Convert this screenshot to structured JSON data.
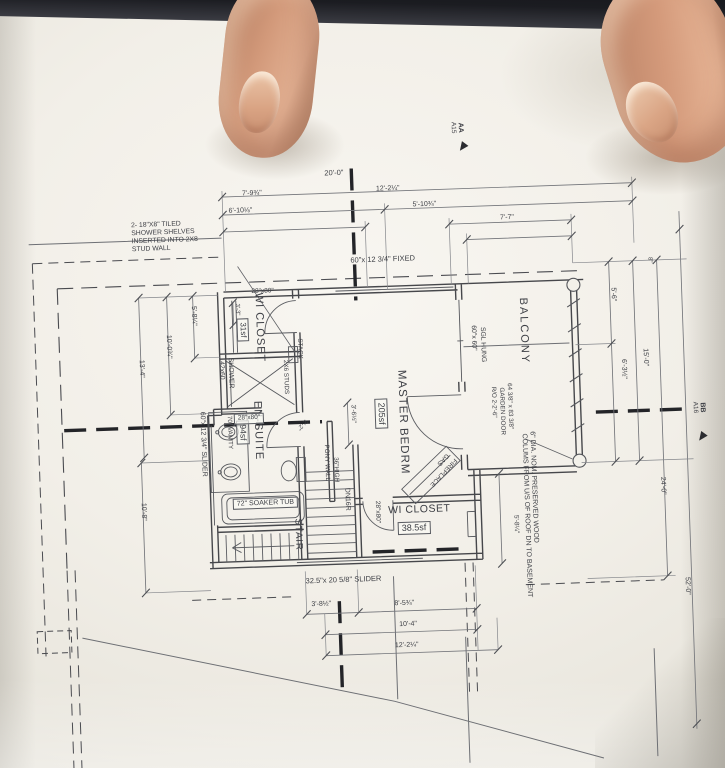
{
  "photo": {
    "paper_color": "#f2efe8",
    "line_color": "#4a4b4f",
    "table_color": "#15161a",
    "skin_color": "#d49a7b"
  },
  "rooms": {
    "master_name": "MASTER BEDRM",
    "master_area": "205sf",
    "ensuite_name": "EN-SUITE",
    "ensuite_area": "94sf",
    "wicloset_top_name": "WI CLOSET",
    "wicloset_top_area": "31sf",
    "wicloset_bot_name": "WI CLOSET",
    "wicloset_bot_area": "38.5sf",
    "balcony_name": "BALCONY",
    "stair_name": "STAIR"
  },
  "fixtures": {
    "soaker_tub": "72\" SOAKER TUB",
    "shower_size": "42x60",
    "shower_word": "SHOWER",
    "vanity": "70\" VANITY",
    "pony_wall_l1": "36\"HIGH",
    "pony_wall_l2": "PONY WALL",
    "fireplace_l1": "GAS",
    "fireplace_l2": "FIREPLACE",
    "stack": "STACK",
    "studs": "2X6 STUDS",
    "stair_down": "DN16R"
  },
  "openings": {
    "fixed_window": "60\"x 12 3/4\" FIXED",
    "slider_window": "60\"x 12 3/4\" SLIDER",
    "bottom_slider": "32.5\"x 20 5/8\" SLIDER",
    "sgl_hung_l1": "60\"x 60\"",
    "sgl_hung_l2": "SGL HUNG",
    "garden_l1": "R/O 2-2'-6\"",
    "garden_l2": "GARDEN DOOR",
    "garden_l3": "64 3/8\" x 83 3/8\"",
    "door1": "28\"x80\"",
    "door2": "28\"x80\"",
    "door3": "28\"x80\""
  },
  "notes": {
    "shelves_l1": "2- 18\"X8\" TILED",
    "shelves_l2": "SHOWER SHELVES",
    "shelves_l3": "INSERTED INTO 2X8",
    "shelves_l4": "STUD WALL",
    "columns_l1": "6\" DIA. NOM. PRESERVED WOOD",
    "columns_l2": "COLUMS FROM U/S OF ROOF DN TO BASEMENT"
  },
  "markers": {
    "aa": "AA",
    "aa_sheet": "A15",
    "bb": "BB",
    "bb_sheet": "A16"
  },
  "dims": {
    "top_full": "20'-0\"",
    "top_l": "7'-9¾\"",
    "top_r": "12'-2¼\"",
    "top_l2": "6'-10⅛\"",
    "top_r2": "5'-10¾\"",
    "balcony_w": "7'-7\"",
    "bot_1": "3'-8½\"",
    "bot_2": "8'-5¾\"",
    "bot_3": "10'-4\"",
    "bot_4": "12'-2¼\"",
    "left_1": "5'-8¼\"",
    "left_2": "10'-0¾\"",
    "left_3": "13'-4\"",
    "left_4": "10'-8\"",
    "right_8": "8\"",
    "right_1": "5'-6\"",
    "right_2": "6'-3½\"",
    "right_3": "15'-0\"",
    "right_4": "24'-0\"",
    "right_5": "52'-0\"",
    "right_6": "5'-8¼\"",
    "pony": "3'-6½\"",
    "door_sw": "2'-2\"",
    "closet_d": "3'-3\""
  }
}
